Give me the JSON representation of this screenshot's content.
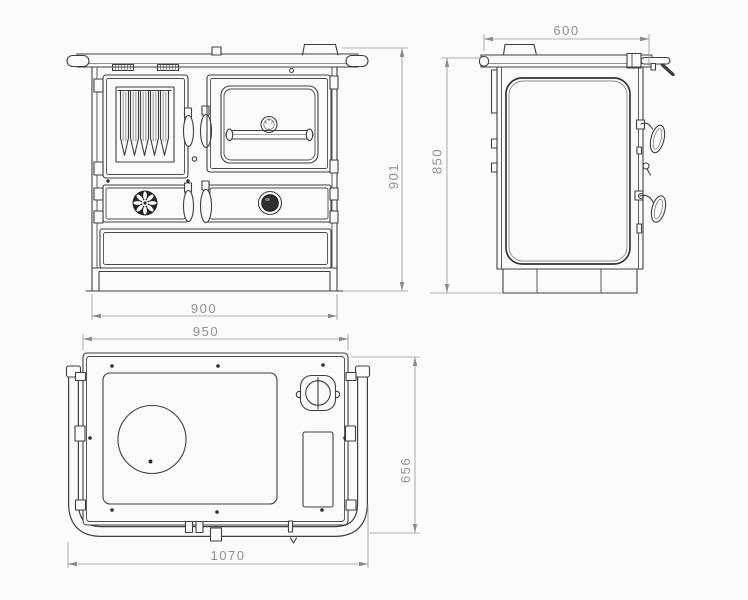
{
  "dimensions": {
    "front_height": "901",
    "front_width": "900",
    "side_depth": "600",
    "side_height": "850",
    "top_plate_width": "950",
    "top_depth": "656",
    "overall_width": "1070"
  },
  "colors": {
    "background": "#fbfbfb",
    "line": "#3f3f3f",
    "dimension": "#8f8f8f"
  }
}
